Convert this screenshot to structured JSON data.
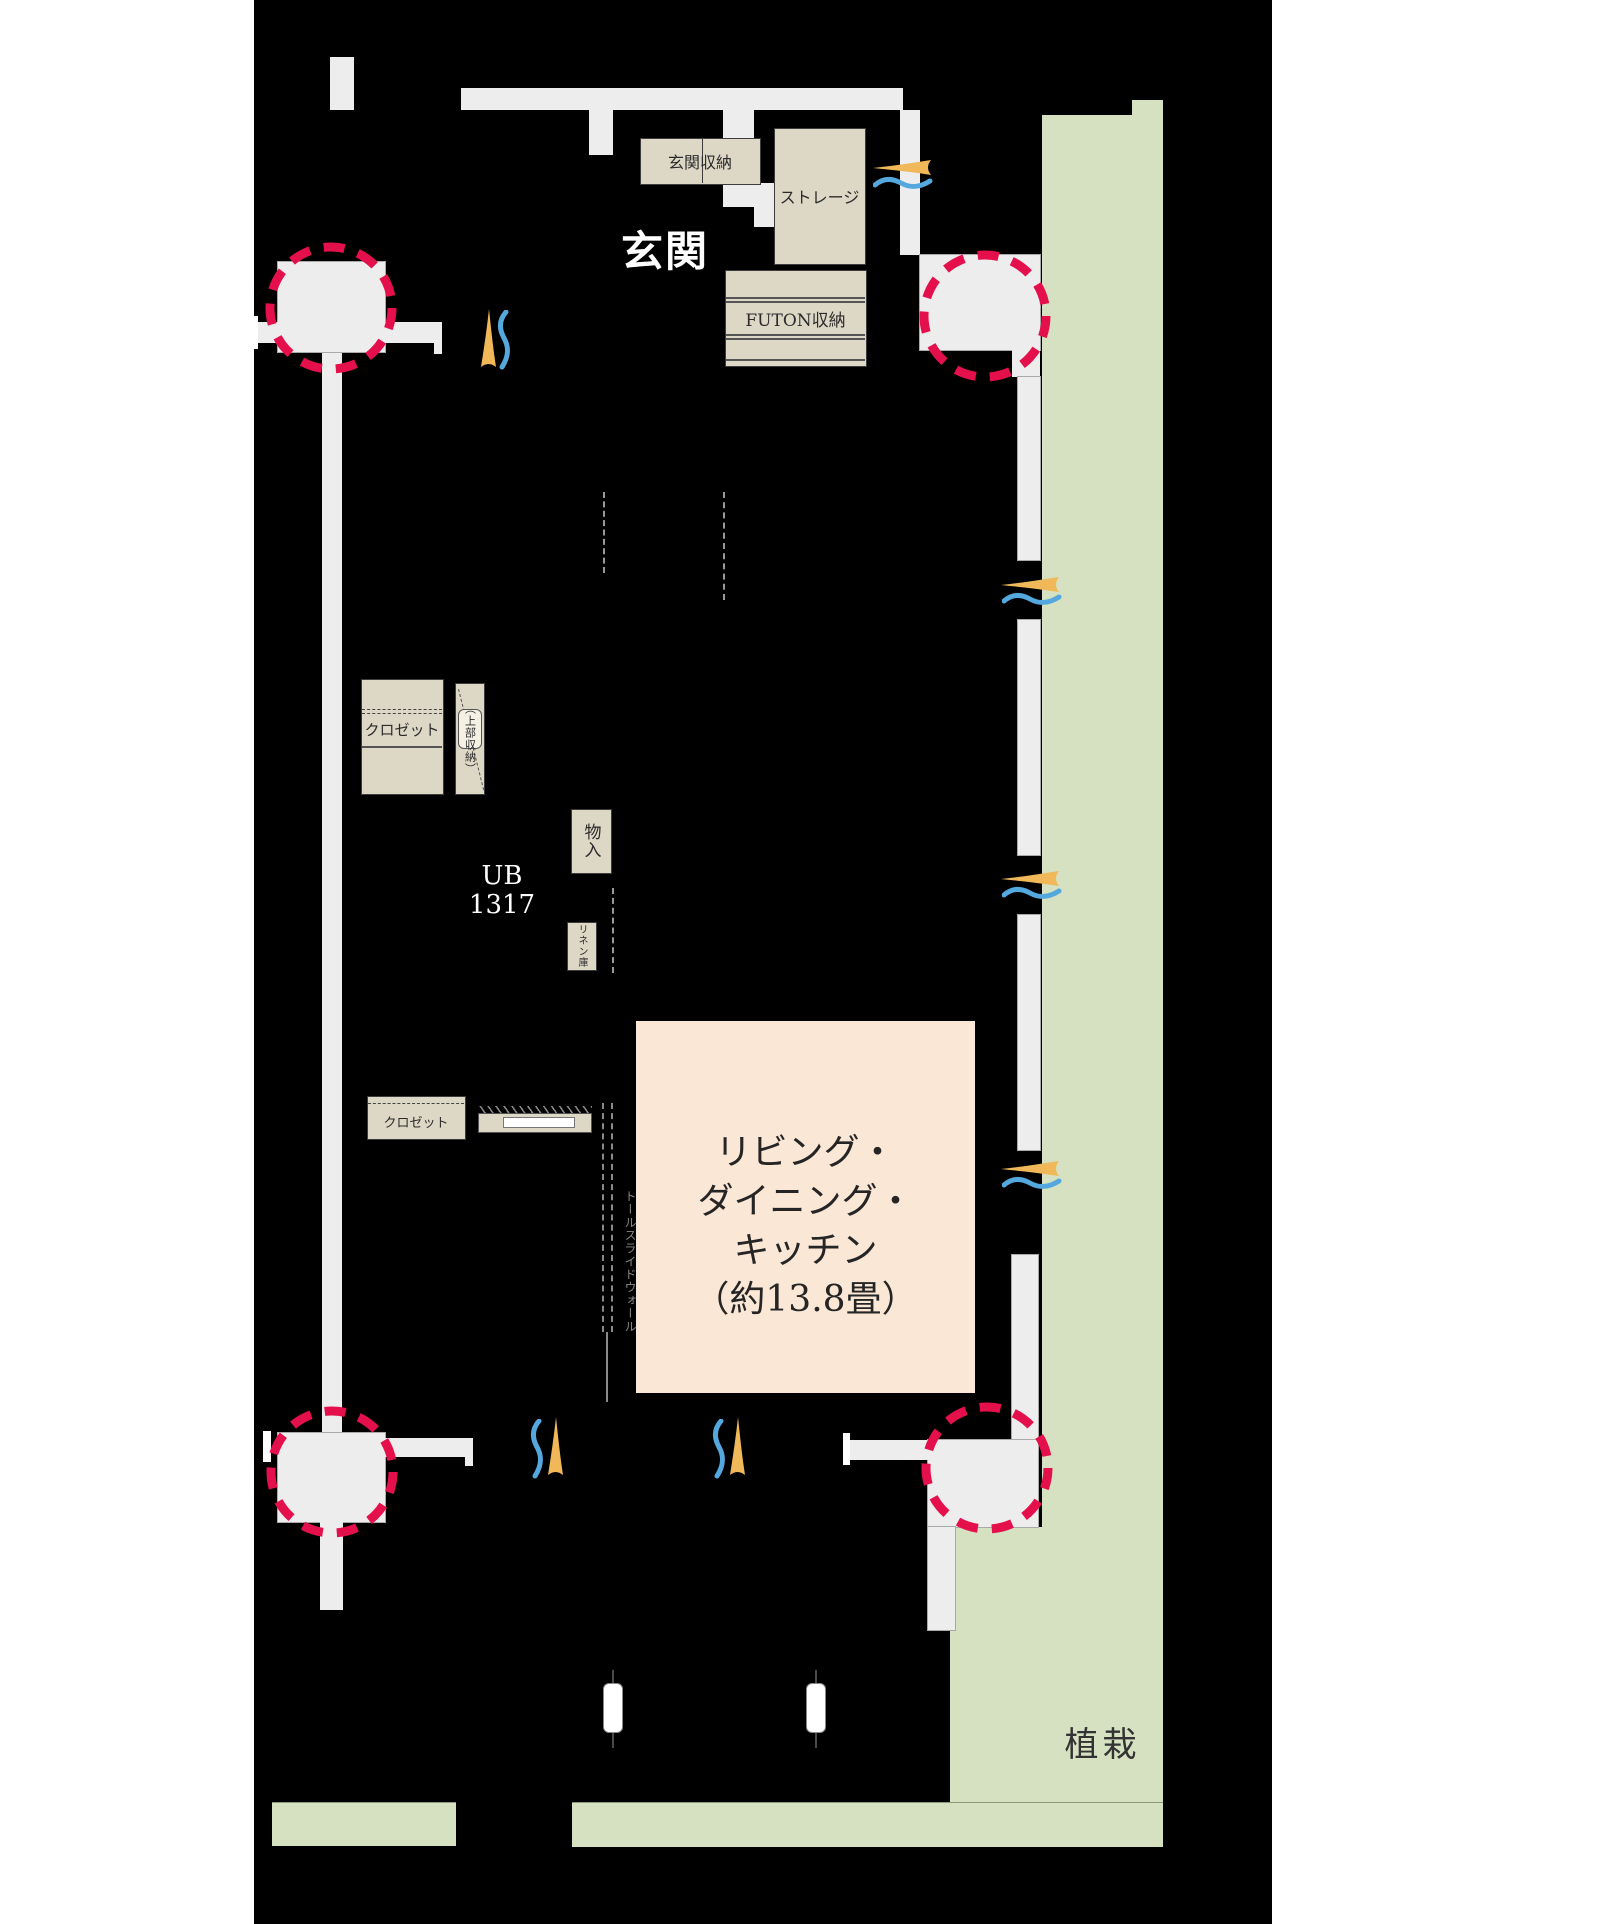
{
  "plan": {
    "title_area": {
      "entrance_label": "玄関",
      "entrance_storage_label": "玄関収納",
      "storage_label": "ストレージ",
      "futon_storage_label": "FUTON収納"
    },
    "middle_area": {
      "closet_upper_label": "クロゼット",
      "upper_storage_label": "（上部収納）",
      "unit_bath_line1": "UB",
      "unit_bath_line2": "1317",
      "monoire_label": "物入",
      "linen_label": "リネン庫"
    },
    "lower_area": {
      "closet_lower_label": "クロゼット",
      "tall_slide_wall_label": "トールスライドウォール",
      "ldk_line1": "リビング・",
      "ldk_line2": "ダイニング・",
      "ldk_line3": "キッチン",
      "ldk_line4": "（約13.8畳）",
      "planting_label": "植栽"
    },
    "colors": {
      "page_background": "#ffffff",
      "floor_background": "#000000",
      "planting_green": "#d5e1c0",
      "wall_gray": "#ededee",
      "storage_beige": "#ddd7c5",
      "ldk_pink": "#fbe7d5",
      "pillar_circle_red": "#e4104c",
      "airflow_flame_orange": "#f0b859",
      "airflow_wave_blue": "#54a8de"
    }
  }
}
